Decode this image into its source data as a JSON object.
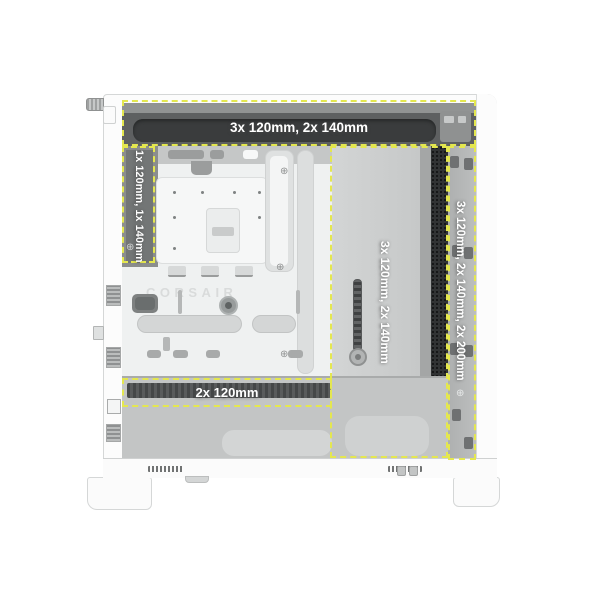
{
  "meta": {
    "title": "PC case fan mounting zones",
    "view": "left side view, side panel removed"
  },
  "brand": {
    "tray_logo": "CORSAIR"
  },
  "icons": {
    "screw_head": "⊕"
  },
  "colors": {
    "highlight_dash": "#e4e74f",
    "label_text": "#ffffff",
    "mesh_dark": "#313334",
    "top_vent_dark": "#5e6061",
    "chassis_white": "#fcfcfc",
    "tray_light": "#eff1f1",
    "chamber_gray": "#cbcdcd",
    "shroud_gray": "#c3c5c5"
  },
  "fan_zones": {
    "top": {
      "label": "3x 120mm, 2x 140mm"
    },
    "rear": {
      "label": "1x 120mm, 1x 140mm"
    },
    "side": {
      "label": "3x 120mm, 2x 140mm"
    },
    "front": {
      "label": "3x 120mm, 2x 140mm, 2x 200mm"
    },
    "bottom": {
      "label": "2x 120mm"
    }
  }
}
